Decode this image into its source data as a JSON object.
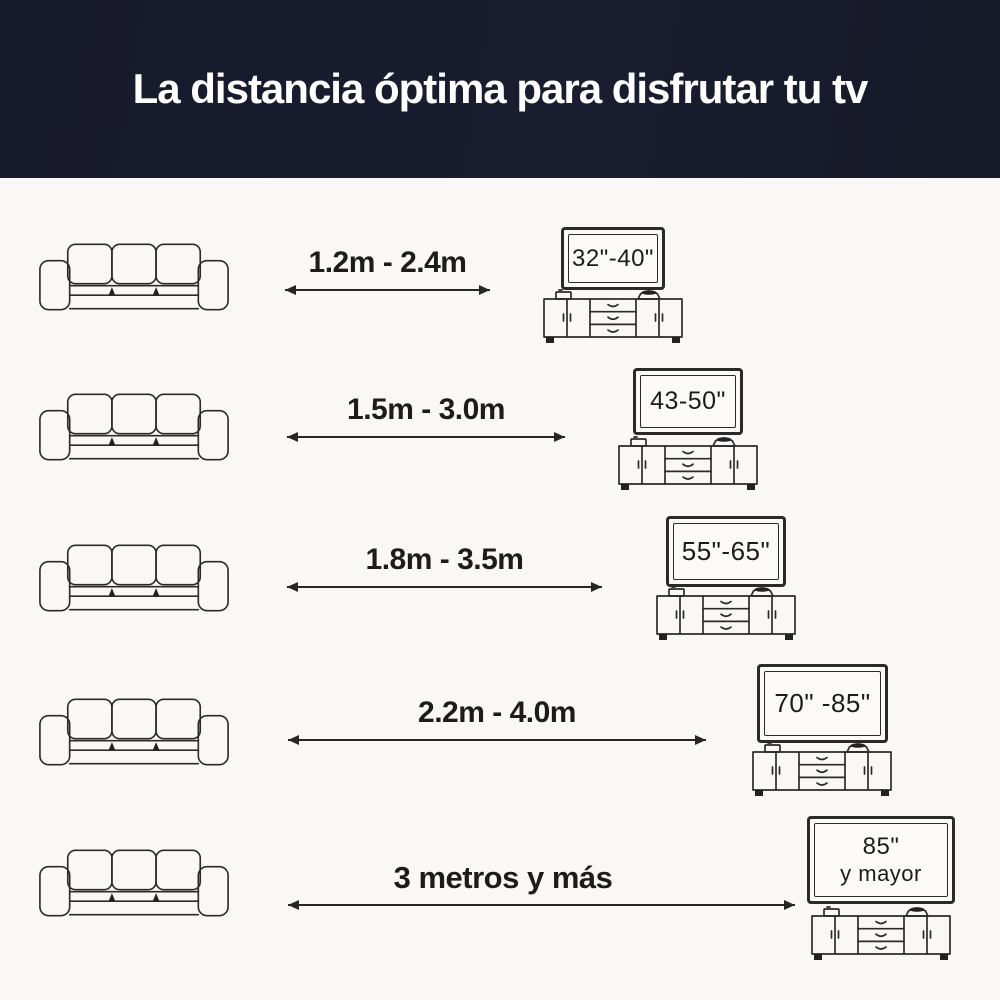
{
  "header": {
    "title": "La distancia óptima para disfrutar tu tv"
  },
  "colors": {
    "header_bg": "#1a1d30",
    "page_bg": "#faf8f6",
    "lineart": "#2b2b2b",
    "text": "#1c1c1c"
  },
  "icons": {
    "sofa": "sofa-icon",
    "distance_arrow": "double-headed-arrow-icon",
    "tv": "tv-screen-icon",
    "tv_stand": "tv-stand-icon"
  },
  "rows": [
    {
      "distance_label": "1.2m - 2.4m",
      "tv_size_label": "32\"-40\"",
      "tv_size_label_line2": ""
    },
    {
      "distance_label": "1.5m - 3.0m",
      "tv_size_label": "43-50\"",
      "tv_size_label_line2": ""
    },
    {
      "distance_label": "1.8m - 3.5m",
      "tv_size_label": "55\"-65\"",
      "tv_size_label_line2": ""
    },
    {
      "distance_label": "2.2m - 4.0m",
      "tv_size_label": "70\" -85\"",
      "tv_size_label_line2": ""
    },
    {
      "distance_label": "3 metros y más",
      "tv_size_label": "85\"",
      "tv_size_label_line2": "y mayor"
    }
  ]
}
